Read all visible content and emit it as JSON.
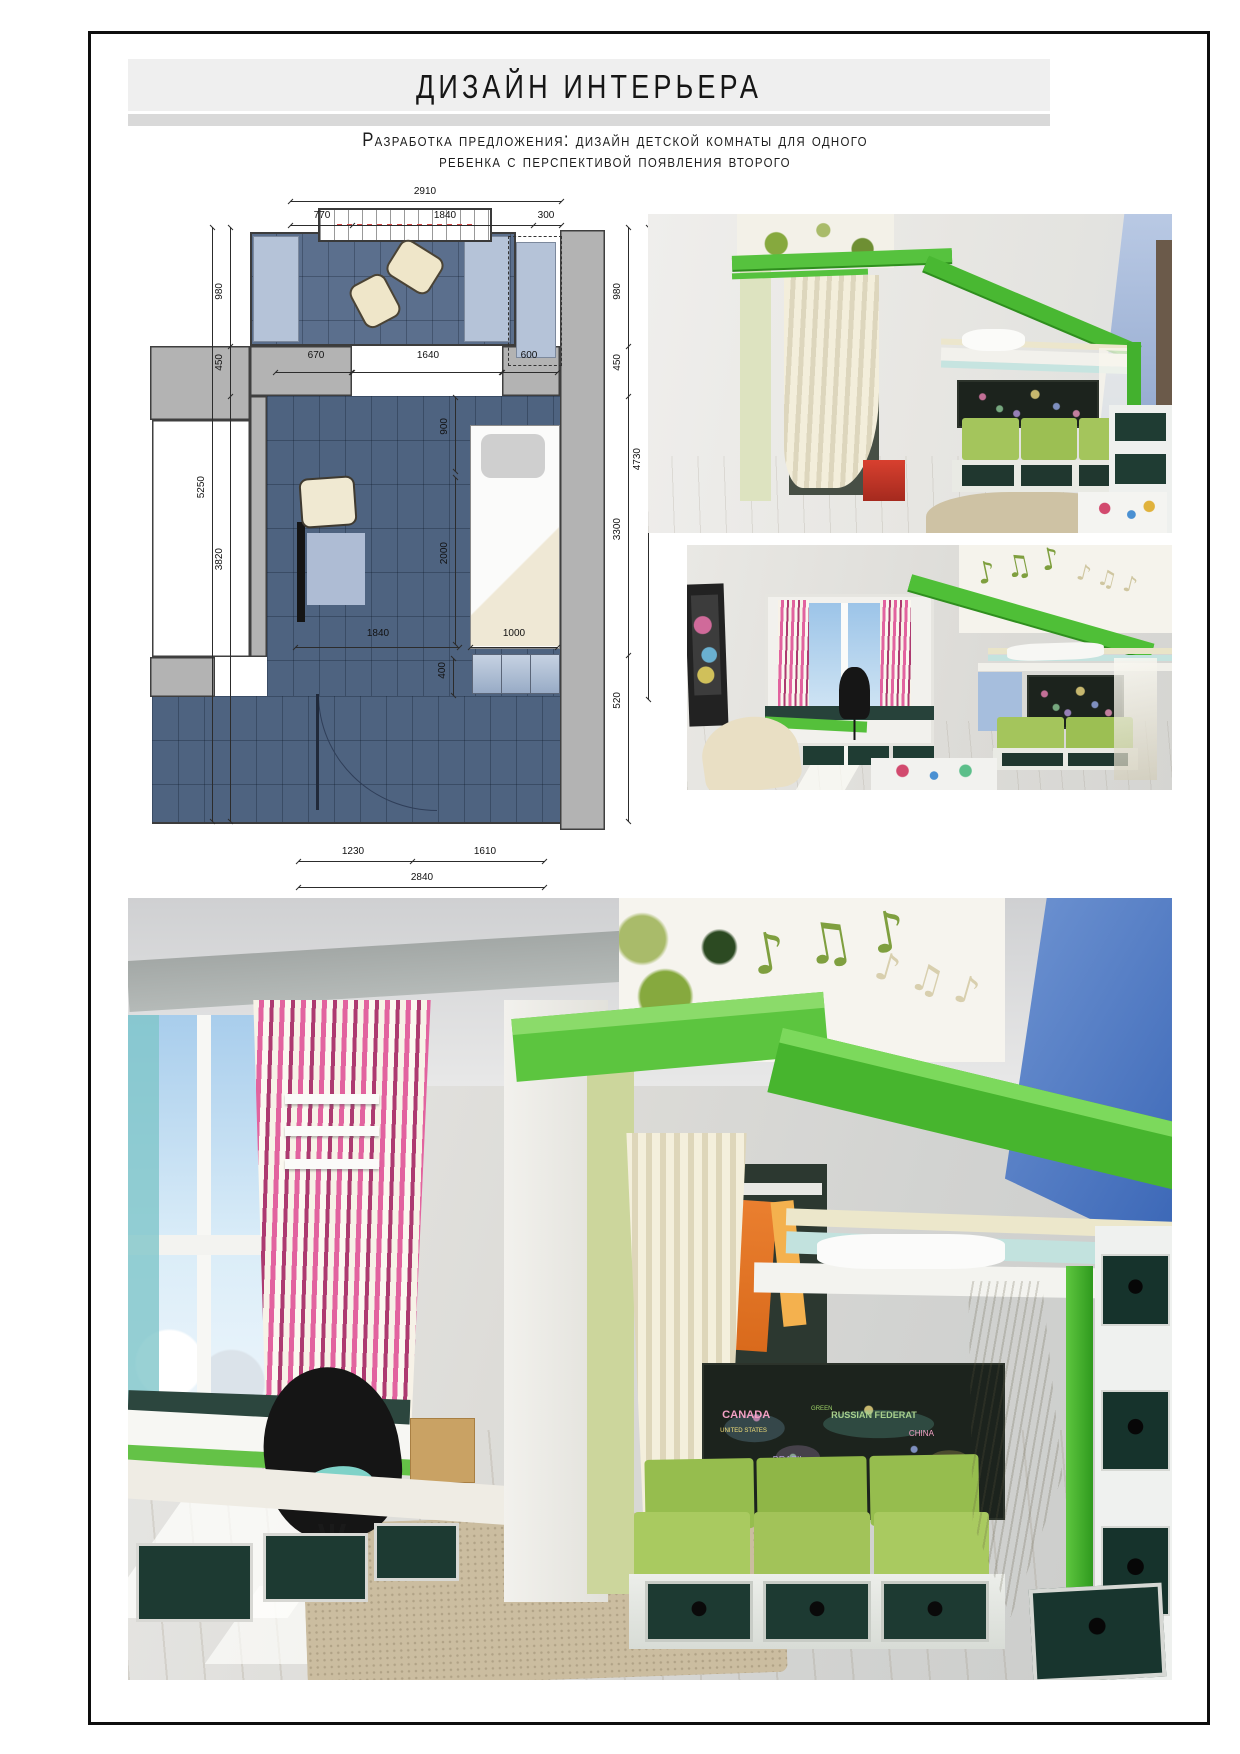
{
  "page": {
    "title": "ДИЗАЙН ИНТЕРЬЕРА",
    "subtitle_line1": "Разработка предложения: дизайн детской комнаты для одного",
    "subtitle_line2": "ребенка с перспективой появления второго"
  },
  "palette": {
    "header_bar": "#efefef",
    "header_strip": "#d9d9d9",
    "plan_floor_blue": "#4e6380",
    "plan_wall_gray": "#b3b3b3",
    "plan_window_blue": "#b5c3d8",
    "accent_green": "#55c13c",
    "sofa_green": "#a6c75f",
    "drawer_teal": "#1e3a33",
    "wall_blue": "#4a76c6",
    "curtain_cream": "#efe9d4",
    "curtain_pink": "#dd5896"
  },
  "floor_plan": {
    "dims": {
      "top_total": "2910",
      "top_a": "770",
      "top_b": "1840",
      "top_c": "300",
      "left_inner_a": "980",
      "left_inner_b": "450",
      "left_inner_c": "3820",
      "left_total": "5250",
      "mid_a": "670",
      "mid_b": "1640",
      "mid_c": "600",
      "inner_a": "900",
      "inner_b": "2000",
      "inner_c": "1840",
      "inner_d": "1000",
      "inner_e": "400",
      "right_inner_a": "980",
      "right_inner_b": "450",
      "right_inner_c": "3300",
      "right_inner_d": "520",
      "right_total": "4730",
      "bottom_a": "1230",
      "bottom_b": "1610",
      "bottom_total": "2840"
    }
  },
  "renders": {
    "map_words": [
      "CANADA",
      "UNITED STATES",
      "RUSSIAN FEDERAT",
      "CHINA",
      "BRAZIL",
      "AUSTR",
      "GREEN"
    ],
    "wallpaper_notes": "♪ ♫ ♪"
  }
}
